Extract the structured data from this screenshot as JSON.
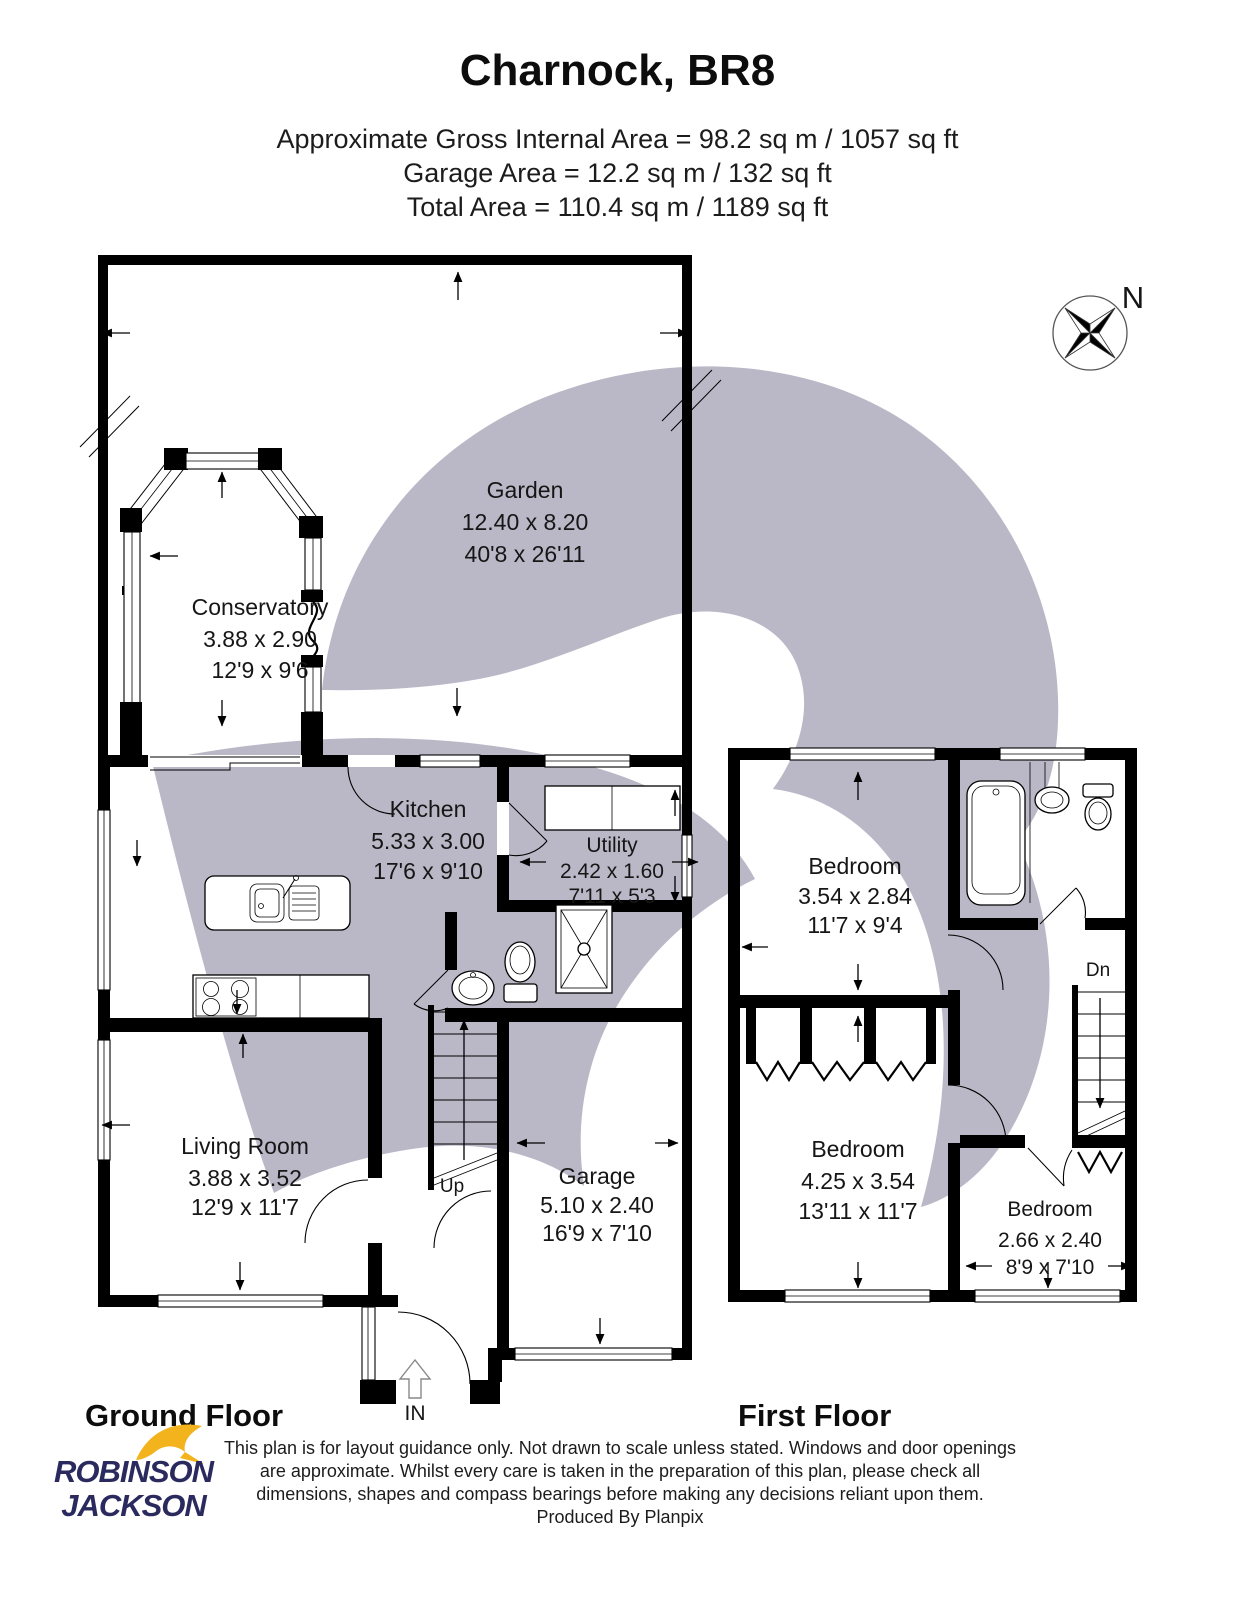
{
  "title": "Charnock, BR8",
  "area_summary": {
    "gross": "Approximate Gross Internal Area = 98.2 sq m / 1057 sq ft",
    "garage": "Garage Area = 12.2 sq m / 132 sq ft",
    "total": "Total Area = 110.4 sq m / 1189 sq ft"
  },
  "compass": {
    "north_label": "N"
  },
  "ground_floor": {
    "label": "Ground Floor",
    "entrance_label": "IN",
    "stairs_label": "Up",
    "rooms": {
      "garden": {
        "name": "Garden",
        "metric": "12.40 x 8.20",
        "imperial": "40'8 x 26'11"
      },
      "conservatory": {
        "name": "Conservatory",
        "metric": "3.88 x 2.90",
        "imperial": "12'9 x 9'6"
      },
      "kitchen": {
        "name": "Kitchen",
        "metric": "5.33 x 3.00",
        "imperial": "17'6 x 9'10"
      },
      "utility": {
        "name": "Utility",
        "metric": "2.42 x 1.60",
        "imperial": "7'11 x 5'3"
      },
      "living_room": {
        "name": "Living Room",
        "metric": "3.88 x 3.52",
        "imperial": "12'9 x 11'7"
      },
      "garage": {
        "name": "Garage",
        "metric": "5.10 x 2.40",
        "imperial": "16'9 x 7'10"
      }
    }
  },
  "first_floor": {
    "label": "First Floor",
    "stairs_label": "Dn",
    "rooms": {
      "bedroom_1": {
        "name": "Bedroom",
        "metric": "3.54 x 2.84",
        "imperial": "11'7 x 9'4"
      },
      "bedroom_2": {
        "name": "Bedroom",
        "metric": "4.25 x 3.54",
        "imperial": "13'11 x 11'7"
      },
      "bedroom_3": {
        "name": "Bedroom",
        "metric": "2.66 x 2.40",
        "imperial": "8'9 x 7'10"
      }
    }
  },
  "footer": {
    "brand": {
      "line1": "ROBINSON",
      "line2": "JACKSON"
    },
    "disclaimer": {
      "line1": "This plan is for layout guidance only. Not drawn to scale unless stated. Windows and door openings",
      "line2": "are approximate. Whilst every care is taken in the preparation of this plan, please check all",
      "line3": "dimensions, shapes and compass bearings before making any decisions reliant upon them.",
      "line4": "Produced By Planpix"
    }
  },
  "colors": {
    "wall": "#000000",
    "watermark": "#bab8c6",
    "brand_navy": "#2b2a5e",
    "brand_yellow": "#f2b31c"
  }
}
